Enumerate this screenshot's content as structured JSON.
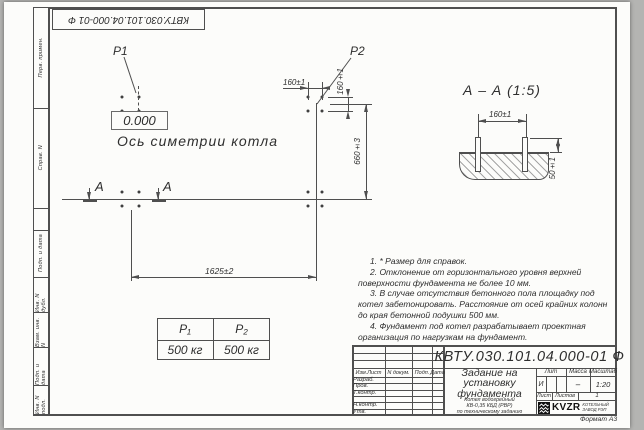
{
  "frame": {
    "doc_number_top": "КВТУ.030.101.04.000-01 Ф",
    "format_note": "Формат А3",
    "side_labels": [
      "Перв. примен.",
      "Справ. N",
      "Подп. и дата",
      "Инв. N дубл.",
      "Взам. инв. N",
      "Подп. и дата",
      "Инв. N подл."
    ]
  },
  "plan": {
    "p1": "P1",
    "p2": "P2",
    "elevation": "0.000",
    "axis_label": "Ось симетрии котла",
    "section_letter_left": "А",
    "section_letter_right": "А",
    "dim_width": "1625±2",
    "dim_height": "660±3",
    "dim_bolt_h": "160±1",
    "dim_bolt_v": "160±1"
  },
  "section_view": {
    "title": "А – А (1:5)",
    "dim_span": "160±1",
    "dim_protrusion": "50±1"
  },
  "load_table": {
    "headers": [
      "P₁",
      "P₂"
    ],
    "values": [
      "500 кг",
      "500 кг"
    ]
  },
  "notes": [
    "1. * Размер для справок.",
    "2. Отклонение от горизонтального уровня верхней поверхности фундамента не более 10 мм.",
    "3. В случае отсутствия бетонного пола площадку под котел забетонировать. Расстояние от осей крайних колонн до края бетонной подушки 500 мм.",
    "4. Фундамент под котел разрабатывает проектная организация по нагрузкам на фундамент."
  ],
  "title_block": {
    "doc_number": "КВТУ.030.101.04.000-01 Ф",
    "title": "Задание на установку фундамента",
    "product": [
      "Котел водогрейный",
      "КВ-0,35 КБД (РВР)",
      "по техническому заданию"
    ],
    "header_cols": [
      "Изм.Лист",
      "N докум.",
      "Подп.",
      "Дата"
    ],
    "sign_rows": [
      "Разраб.",
      "Пров.",
      "Т.контр.",
      "",
      "Н.контр.",
      "Утв."
    ],
    "lit_label": "Лит",
    "mass_label": "Масса",
    "scale_label": "Масштаб",
    "lit_value": "И",
    "mass_value": "–",
    "scale_value": "1:20",
    "sheet_label": "Лист",
    "sheets_label": "Листов",
    "sheets_value": "1",
    "logo_text": "KVZR",
    "logo_caption": [
      "КОТЕЛЬНЫЙ",
      "ЗАВОД РЭП"
    ]
  },
  "colors": {
    "line": "#4f4f4f",
    "paper": "#fcfcfa",
    "background": "#b4b4b2"
  }
}
